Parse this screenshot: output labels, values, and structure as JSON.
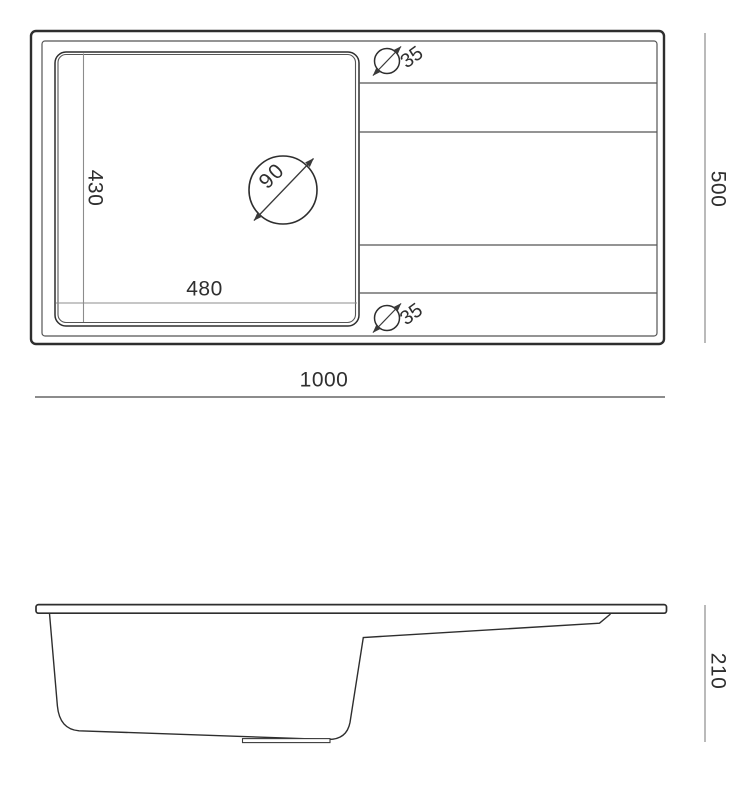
{
  "top_view": {
    "overall_width_label": "1000",
    "overall_depth_label": "500",
    "bowl_width_label": "480",
    "bowl_depth_label": "430",
    "drain_hole_diameter_label": "90",
    "tap_hole_top_label": "35",
    "tap_hole_bottom_label": "35"
  },
  "side_view": {
    "overall_height_label": "210"
  },
  "colors": {
    "outline": "#2e2e2e",
    "thin_line": "#555555",
    "dimension_line": "#8c8c8c",
    "label_text": "#2f2f2f",
    "background": "#ffffff"
  }
}
